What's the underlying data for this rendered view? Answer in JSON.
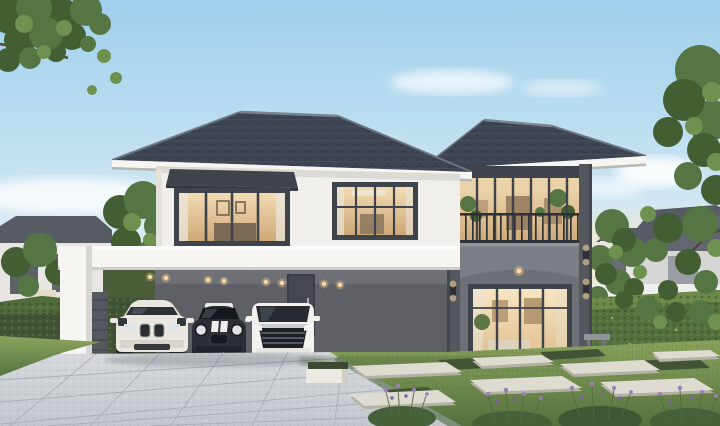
{
  "canvas": {
    "width": 720,
    "height": 426
  },
  "scene": {
    "type": "architectural-render",
    "description": "Photorealistic rendering of a modern two-storey luxury house at dusk: dark hip roofs, white upper facade, grey ground floor, glass balcony wing with arched portico, white carport sheltering three cars (white SUV, black mini hatchback, white luxury van), paved driveway, lawn with stepping stones, boxwood patches and lavender, flanked by hedges, trees and neighbouring houses",
    "time_of_day": "dusk",
    "objects": [
      "sky",
      "clouds",
      "tree-top-left",
      "tree-right",
      "background-trees-left",
      "background-trees-right",
      "neighbor-house-left",
      "neighbor-house-right",
      "distant-house",
      "fence-left",
      "fence-right",
      "hedge-left",
      "hedge-right",
      "main-roof",
      "right-wing-roof",
      "second-floor-wall",
      "bay-window",
      "upper-middle-window",
      "lower-middle-window",
      "glass-balcony-wing",
      "balcony-railing",
      "arched-portico",
      "glass-entry-doors",
      "wall-sconces",
      "carport",
      "carport-downlights",
      "entry-door",
      "suv-car",
      "mini-car",
      "van-car",
      "driveway",
      "lawn",
      "stepping-stones",
      "boxwood-patches",
      "planter-box",
      "lavender-bed",
      "garden-bench"
    ]
  },
  "palette": {
    "sky_top": "#9fd0eb",
    "sky_mid": "#c9e3f2",
    "sky_low": "#e6eff1",
    "sky_horizon": "#f0e6d6",
    "cloud": "#ffffff",
    "roof_dark": "#3d4452",
    "roof_shadow": "#2c3440",
    "roof_ridge": "#76markdown8088",
    "fascia_white": "#f6f5f2",
    "wall_white": "#f1efec",
    "wall_white_shade": "#dcdad4",
    "wall_gray": "#8d8d90",
    "wall_gray_dark": "#7a7a7e",
    "tower_gray": "#7b7e85",
    "frame_dark": "#3f434a",
    "column_dark": "#54575e",
    "glass_warm": "#f2dcb4",
    "glass_warm_deep": "#cfa878",
    "glass_cool": "#b9c6cd",
    "interior_dark": "#6b5a46",
    "curtain": "#eae4d8",
    "ceiling_gray": "#66676c",
    "backwall_gray": "#5f6065",
    "door_dark": "#3a3d43",
    "light_warm": "#ffd9a0",
    "hedge_dark": "#415435",
    "hedge_mid": "#55703f",
    "hedge_light": "#6f8c4a",
    "tree_dark": "#435e33",
    "tree_mid": "#567544",
    "tree_light": "#6f9150",
    "branch": "#5a4936",
    "grass_light": "#8aa45c",
    "grass_mid": "#6f8c4c",
    "grass_dark": "#55713f",
    "pave_light": "#d5d9dd",
    "pave_mid": "#c2c7cd",
    "pave_joint": "#a6acb3",
    "stone_light": "#dedbd0",
    "stone_shadow": "#b4b1a5",
    "lavender": "#9c7fb8",
    "lavender_deep": "#82619f",
    "car_white": "#eae7e0",
    "car_dark": "#2b2f35",
    "van_white": "#f2f1ee",
    "neighbor_wall": "#e7e6e2",
    "neighbor_roof": "#575c64",
    "fence_white": "#eff0ee"
  }
}
